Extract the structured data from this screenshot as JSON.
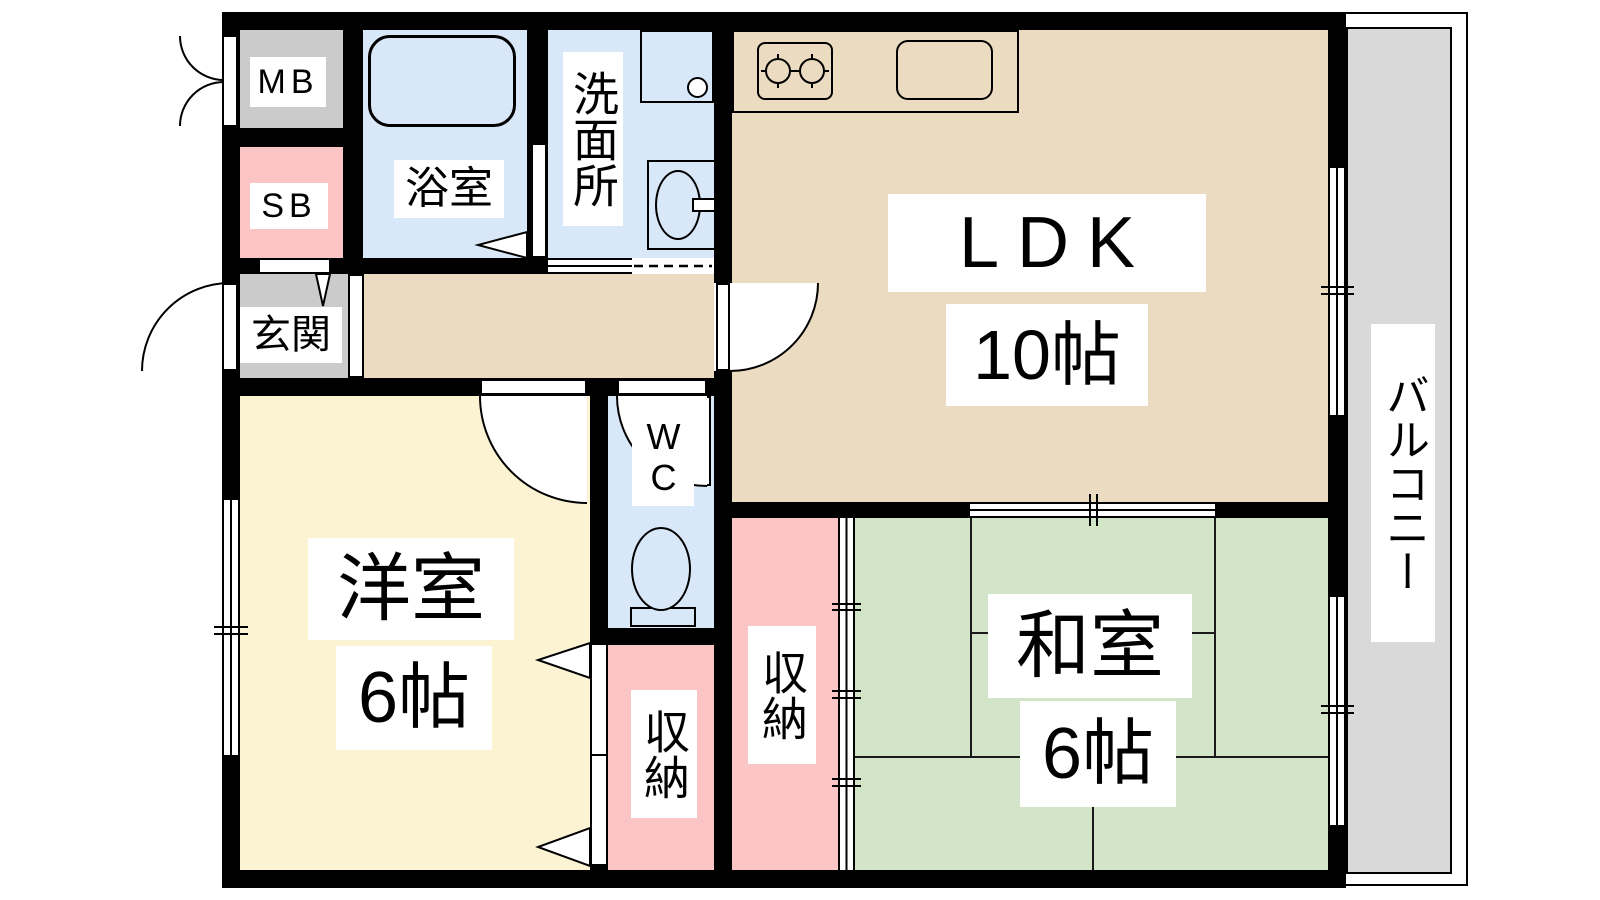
{
  "rooms": {
    "ldk": {
      "label": "LDK",
      "size": "10帖"
    },
    "washitsu": {
      "label": "和室",
      "size": "6帖"
    },
    "youshitsu": {
      "label": "洋室",
      "size": "6帖"
    },
    "balcony": {
      "label": "バルコニー"
    },
    "genkan": {
      "label": "玄関"
    },
    "bathroom": {
      "label": "浴室"
    },
    "washroom": {
      "label": "洗面所"
    },
    "wc": {
      "label": "WC"
    },
    "closet_youshitsu": {
      "label": "収納"
    },
    "closet_washitsu": {
      "label": "収納"
    },
    "meter_box": {
      "label": "MB"
    },
    "shoe_box": {
      "label": "SB"
    }
  },
  "colors": {
    "wall": "#000000",
    "ldk_floor": "#EBDBC0",
    "tatami_green": "#D3E5C9",
    "youshitsu_floor": "#FCF3D3",
    "closet_pink": "#FBC4C5",
    "water_blue": "#D8E8F9",
    "genkan_gray": "#CBCBCB",
    "balcony_gray": "#D9D9D9"
  }
}
